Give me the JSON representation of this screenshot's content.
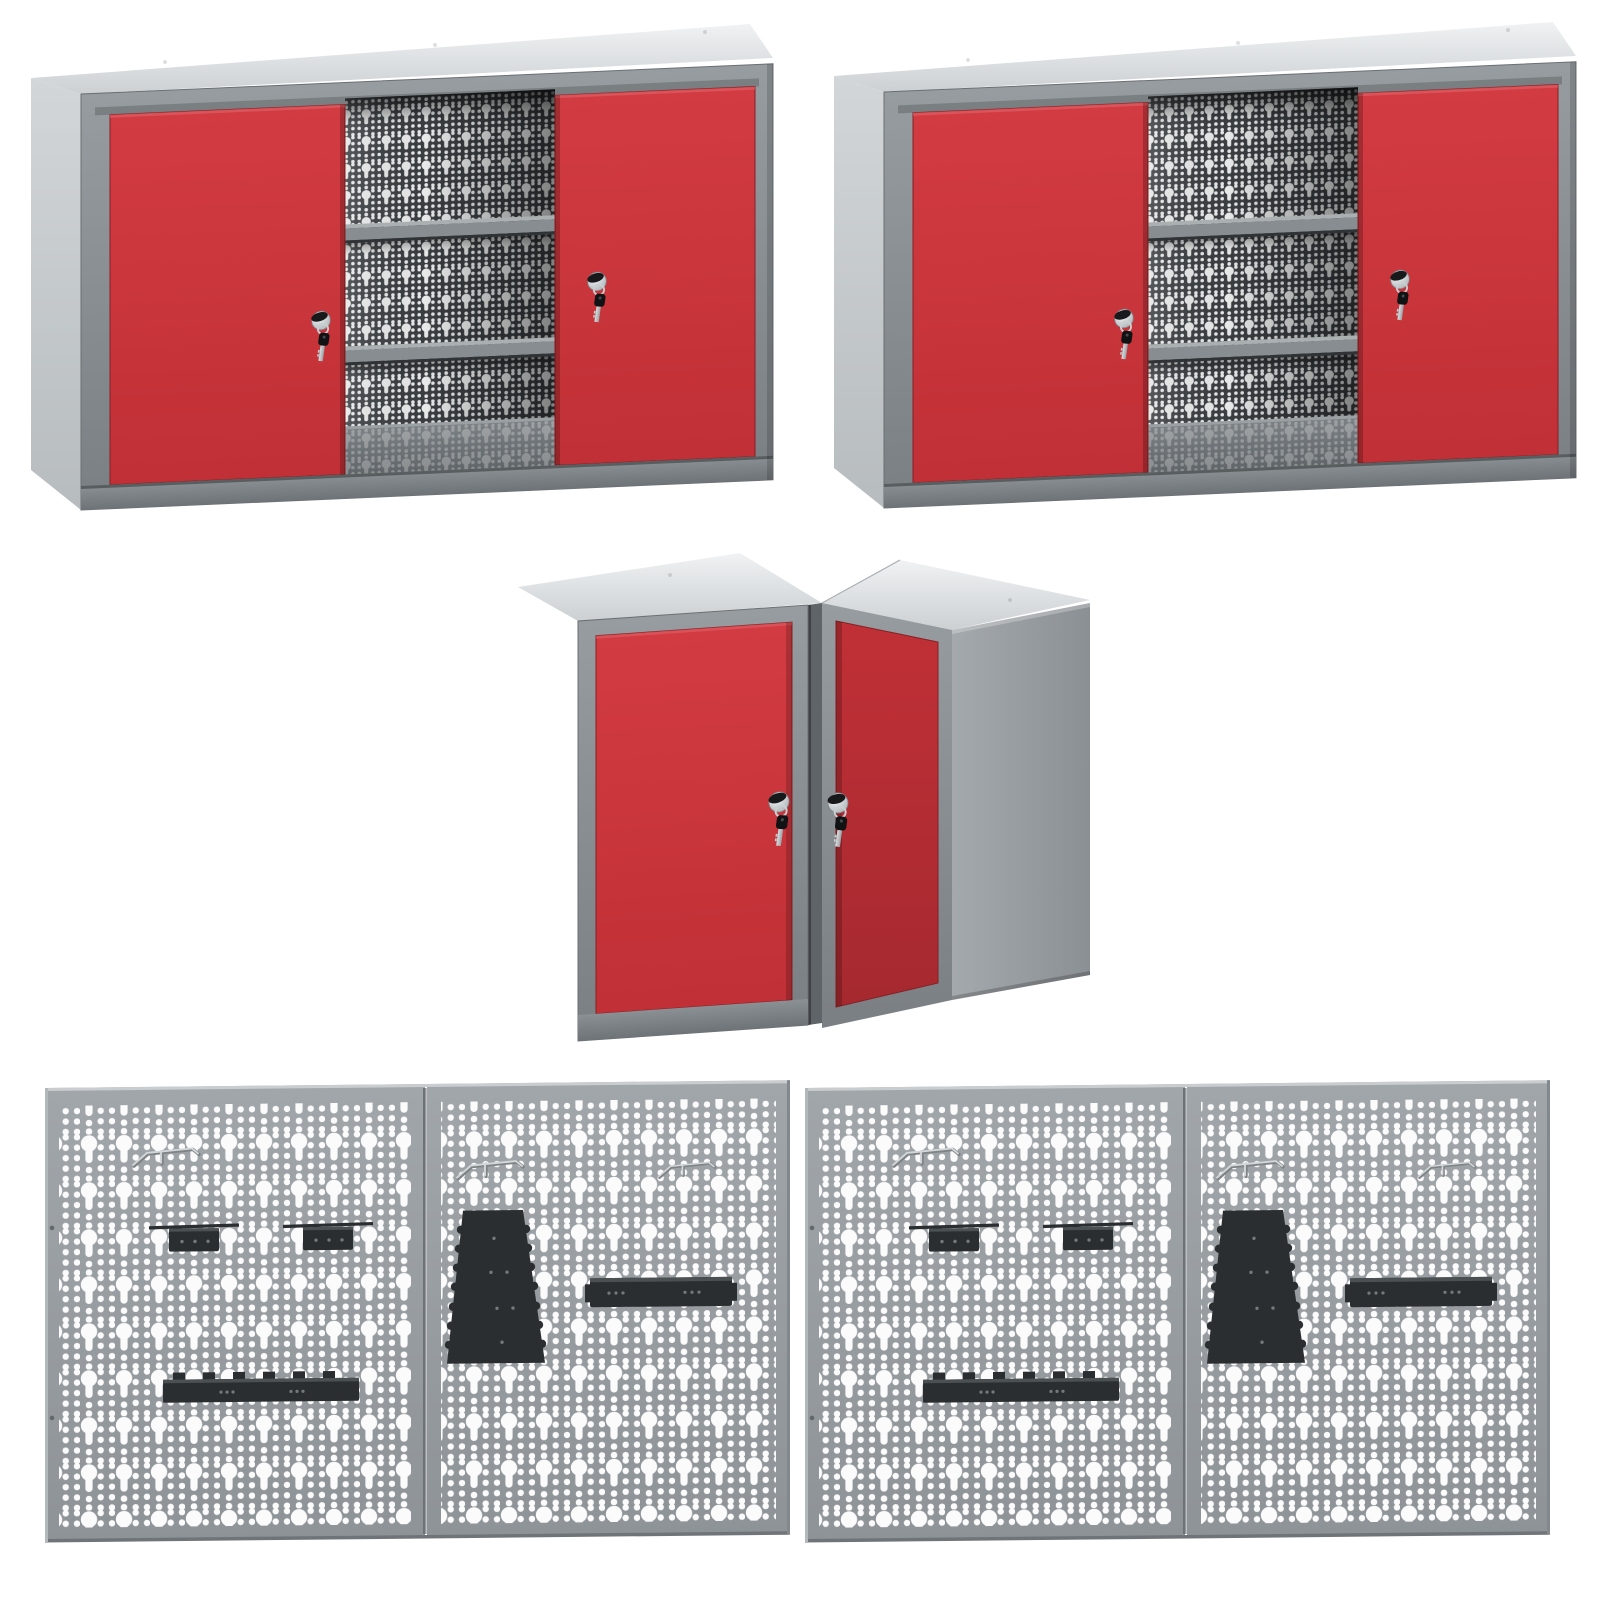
{
  "page": {
    "background": "#ffffff"
  },
  "colors": {
    "background": "#ffffff",
    "door_red_light": "#d23b41",
    "door_red": "#c03036",
    "door_red_deep": "#a62930",
    "door_red_edge": "#862024",
    "frame_gray": "#969ca0",
    "frame_gray_dark": "#7a7f83",
    "post_gray": "#5f6468",
    "rail_hi": "#8a9094",
    "rail_lo": "#6e7377",
    "top_hi": "#f0f2f3",
    "top_lo": "#ccd0d3",
    "side_hi": "#d2d6d8",
    "side_lo": "#b7bcbf",
    "slab_hi": "#a4a9ad",
    "slab_lo": "#8b9094",
    "panel_hi": "#a1a6aa",
    "panel_lo": "#8e9397",
    "panel_edge_light": "#c9cdd0",
    "panel_edge_dark": "#6f7478",
    "seam_dark": "#6d7276",
    "seam_light": "#bdc1c4",
    "interior_dark": "#3a3e41",
    "floor_hi": "#7d8286",
    "floor_lo": "#5d6266",
    "shelf_light": "#aaafb2",
    "shelf_mid": "#878d91",
    "shelf_dark": "#303335",
    "hole_white": "#ffffff",
    "accessory_black": "#2a2e31",
    "accessory_lip": "#4b5053",
    "accessory_dot": "#75797d",
    "wire_gray": "#d3d7d9",
    "wire_shadow": "#7e8386",
    "chrome_hi": "#f5f7f8",
    "chrome_lo": "#a5abaf",
    "cap_black": "#17191b",
    "key_black": "#101214",
    "key_stem_hi": "#dcdfe1",
    "key_stem_lo": "#999fa3"
  },
  "scene": {
    "items": [
      {
        "id": "wall-cabinet-top-left",
        "doors": 2,
        "door_color_key": "door_red",
        "visible_shelves": 2,
        "keys_in_locks": 2,
        "back_panel": "perforated"
      },
      {
        "id": "wall-cabinet-top-right",
        "doors": 2,
        "door_color_key": "door_red",
        "visible_shelves": 2,
        "keys_in_locks": 2,
        "back_panel": "perforated"
      },
      {
        "id": "corner-wall-cabinet",
        "doors": 2,
        "door_color_key": "door_red",
        "keys_in_locks": 2
      },
      {
        "id": "pegboard-set-left",
        "sub_panels": 2,
        "wire_hooks": 3,
        "clamp_holders": 2,
        "tapered_holders": 1,
        "shelf_holders": 1,
        "tool_rails": 1
      },
      {
        "id": "pegboard-set-right",
        "sub_panels": 2,
        "wire_hooks": 3,
        "clamp_holders": 2,
        "tapered_holders": 1,
        "shelf_holders": 1,
        "tool_rails": 1
      }
    ]
  }
}
